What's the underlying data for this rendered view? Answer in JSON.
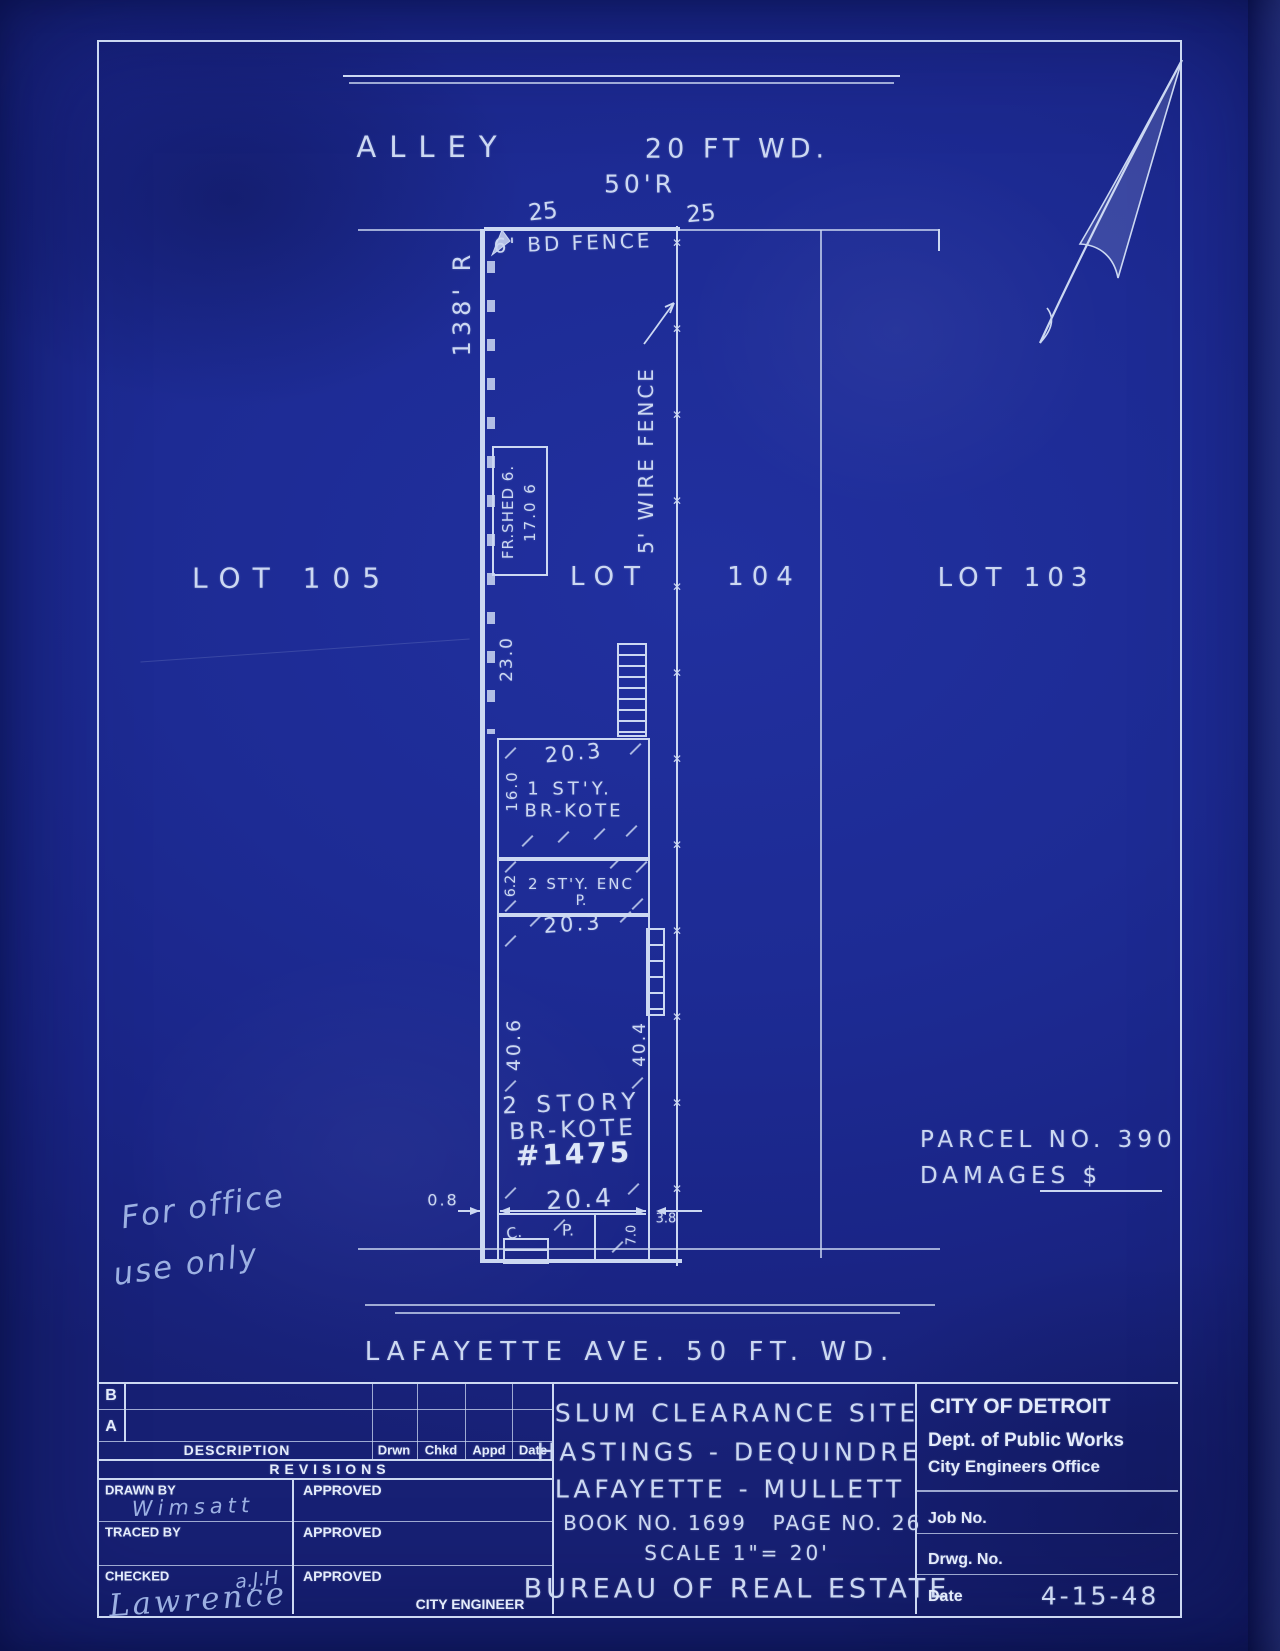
{
  "drawing": {
    "alley_label": "ALLEY",
    "alley_width": "20 FT WD.",
    "curve_radius": "50'R",
    "dim_25_left": "25",
    "dim_25_right": "25",
    "west_radius": "138' R",
    "board_fence_label": "6' BD FENCE",
    "wire_fence_label": "5' WIRE FENCE",
    "wire_fence_marks": "✕✕✕✕✕✕✕✕✕✕✕✕",
    "lot_105": "LOT 105",
    "lot_104_left": "LOT",
    "lot_104_right": "104",
    "lot_103": "LOT 103",
    "shed_label": "FR.SHED 6.",
    "shed_depth": "17.0 6",
    "dim_23_0": "23.0",
    "first_story": {
      "width_top": "20.3",
      "line1": "1 ST'Y.",
      "line2": "BR-KOTE",
      "depth": "16.0"
    },
    "porch": {
      "depth": "6.2",
      "line1": "2 ST'Y. ENC",
      "line2": "P.",
      "width_bottom": "20.3"
    },
    "main_house": {
      "depth_west": "40.6",
      "depth_east": "40.4",
      "line1": "2 STORY",
      "line2": "BR-KOTE",
      "house_number": "#1475",
      "offset_west": "0.8",
      "width_front": "20.4",
      "offset_east": "3.8",
      "front_porch_c": "C.",
      "front_porch_p": "P.",
      "front_porch_depth": "7.0"
    },
    "parcel_no": "PARCEL NO. 390",
    "damages_label": "DAMAGES $",
    "office_note_line1": "For office",
    "office_note_line2": "use only",
    "street_label": "LAFAYETTE AVE. 50 FT. WD."
  },
  "titleblock": {
    "rev_row_b": "B",
    "rev_row_a": "A",
    "col_description": "DESCRIPTION",
    "col_drwn": "Drwn",
    "col_chkd": "Chkd",
    "col_appd": "Appd",
    "col_date": "Date",
    "revisions_label": "REVISIONS",
    "drawn_by_label": "DRAWN BY",
    "drawn_by_value": "Wimsatt",
    "approved_label_1": "APPROVED",
    "traced_by_label": "TRACED BY",
    "approved_label_2": "APPROVED",
    "checked_label": "CHECKED",
    "checked_initials": "a.J.H",
    "checked_signature": "Lawrence",
    "approved_label_3": "APPROVED",
    "city_engineer_label": "CITY ENGINEER",
    "project_line1": "SLUM CLEARANCE SITE",
    "project_line2": "HASTINGS - DEQUINDRE",
    "project_line3": "LAFAYETTE - MULLETT",
    "book_no": "BOOK NO. 1699",
    "page_no": "PAGE NO. 26",
    "scale": "SCALE 1\"= 20'",
    "bureau": "BUREAU OF REAL ESTATE",
    "agency_line1": "CITY OF DETROIT",
    "agency_line2": "Dept. of Public Works",
    "agency_line3": "City Engineers Office",
    "job_no_label": "Job No.",
    "drwg_no_label": "Drwg. No.",
    "date_label": "Date",
    "date_value": "4-15-48"
  }
}
